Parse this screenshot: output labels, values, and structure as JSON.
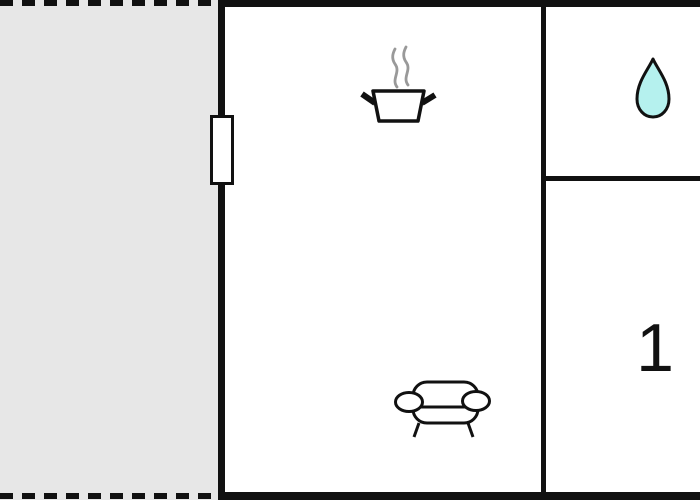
{
  "floorplan": {
    "bedroom_label": "1",
    "icons": [
      {
        "name": "cooking-pot-icon"
      },
      {
        "name": "sofa-icon"
      },
      {
        "name": "water-drop-icon"
      }
    ],
    "colors": {
      "wall": "#111111",
      "terrace_fill": "#e7e7e7",
      "room_fill": "#ffffff",
      "window_fill": "#ffffff",
      "water_drop_fill": "#b5f1ee",
      "steam": "#999999"
    }
  }
}
